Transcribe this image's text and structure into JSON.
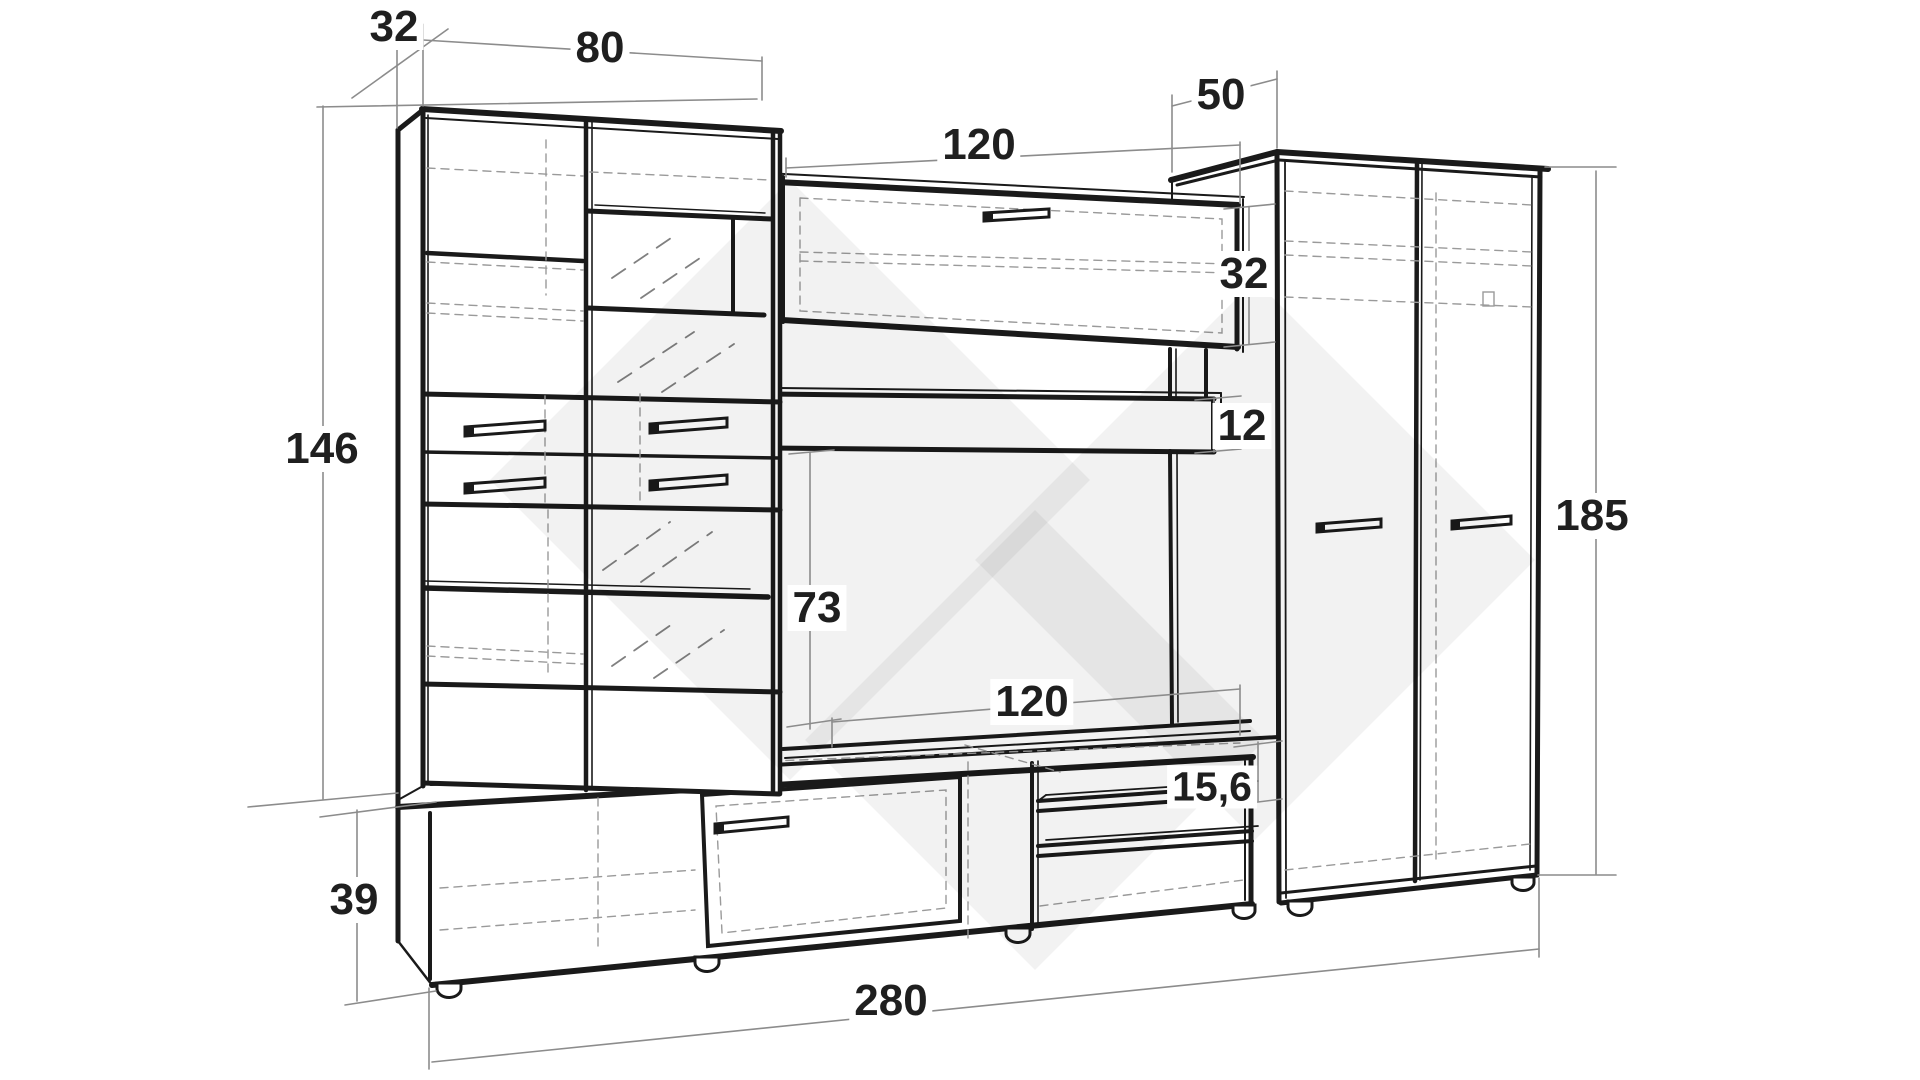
{
  "diagram": {
    "type": "furniture-dimension-drawing",
    "subject": "wall unit with display cabinet, TV stand, wall cabinet and two-door wardrobe"
  },
  "labels": {
    "depth_left_cabinet": "32",
    "width_left_cabinet": "80",
    "width_wall_cabinet": "120",
    "depth_wardrobe": "50",
    "height_wall_cabinet": "32",
    "thickness_shelf": "12",
    "height_left_cabinet": "146",
    "height_tv_space": "73",
    "width_tv_stand_section": "120",
    "gap_shelf": "15,6",
    "height_tv_stand": "39",
    "width_total": "280",
    "height_wardrobe": "185"
  },
  "colors": {
    "background": "#ffffff",
    "line": "#1a1a1a",
    "dim_line": "#8c8c8c",
    "dashed_line": "#9a9a9a",
    "label_text": "#1f1f1f",
    "watermark": "rgba(0,0,0,0.05)"
  }
}
